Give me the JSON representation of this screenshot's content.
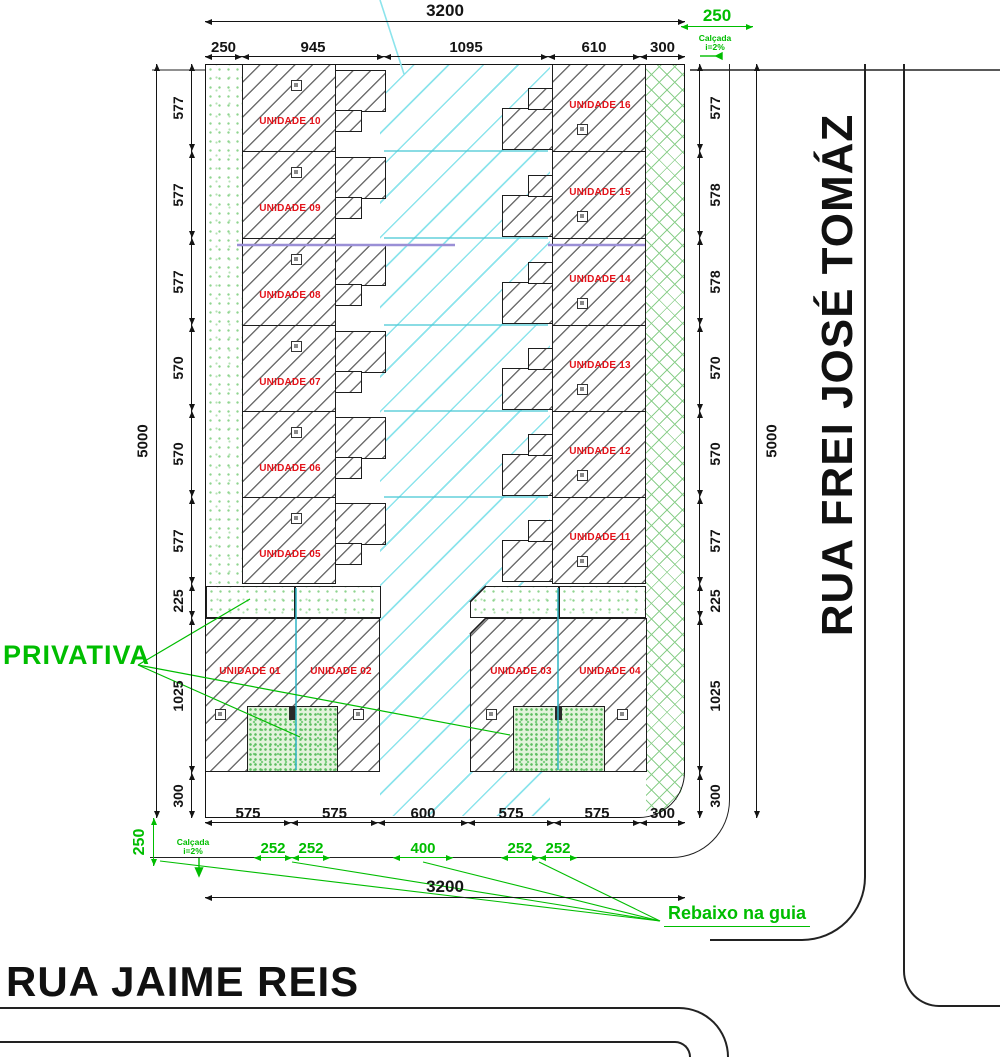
{
  "streets": {
    "right": "RUA FREI JOSÉ TOMÁZ",
    "bottom": "RUA JAIME REIS"
  },
  "annotations": {
    "privativa": "PRIVATIVA",
    "rebaixo": "Rebaixo na guia",
    "calcada_line1": "Calçada",
    "calcada_line2": "i=2%",
    "arrow_right": "→",
    "arrow_down": "↓"
  },
  "units": {
    "left_column": [
      "UNIDADE 10",
      "UNIDADE 09",
      "UNIDADE 08",
      "UNIDADE 07",
      "UNIDADE 06",
      "UNIDADE 05"
    ],
    "right_column": [
      "UNIDADE 16",
      "UNIDADE 15",
      "UNIDADE 14",
      "UNIDADE 13",
      "UNIDADE 12",
      "UNIDADE 11"
    ],
    "bottom_row": [
      "UNIDADE 01",
      "UNIDADE 02",
      "UNIDADE 03",
      "UNIDADE 04"
    ]
  },
  "dimensions": {
    "top_total": "3200",
    "top": [
      "250",
      "945",
      "1095",
      "610",
      "300"
    ],
    "left": [
      "577",
      "577",
      "577",
      "570",
      "570",
      "577",
      "225",
      "1025",
      "300"
    ],
    "left_total": "5000",
    "right": [
      "577",
      "578",
      "578",
      "570",
      "570",
      "577",
      "225",
      "1025",
      "300"
    ],
    "right_total": "5000",
    "bottom": [
      "575",
      "575",
      "600",
      "575",
      "575",
      "300"
    ],
    "bottom_green": [
      "252",
      "252",
      "400",
      "252",
      "252"
    ],
    "bottom_total": "3200",
    "sidewalk_top": "250",
    "sidewalk_left": "250"
  },
  "colors": {
    "unit_label_red": "#e31219",
    "annotation_green": "#00bd00",
    "hatch_gray": "#6f6f6f",
    "driveway_cyan": "#8ce4ec",
    "divider_purple": "#9a8fd6"
  }
}
